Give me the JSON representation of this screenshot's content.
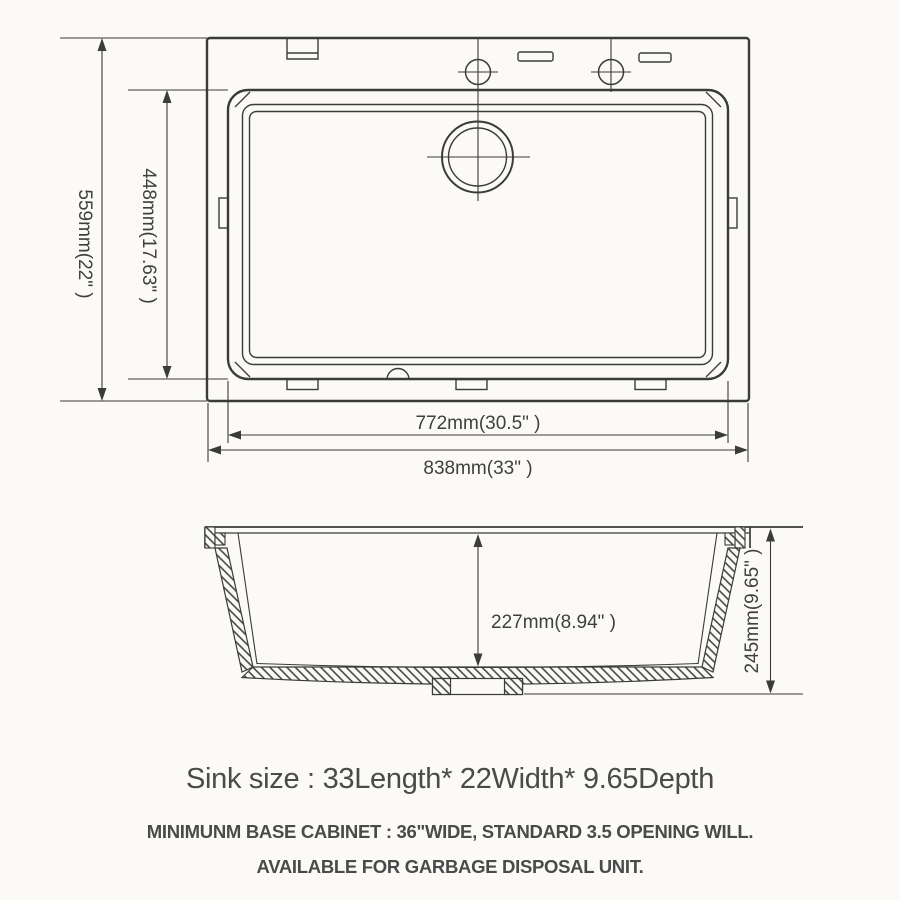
{
  "page": {
    "background": "#fbfaf7",
    "line_color": "#3b3b3b",
    "text_color": "#4a4a4a"
  },
  "top_view": {
    "dims": {
      "outer_height": "559mm(22\" )",
      "inner_height": "448mm(17.63\" )",
      "inner_width": "772mm(30.5\" )",
      "outer_width": "838mm(33\" )"
    }
  },
  "side_view": {
    "dims": {
      "inner_depth": "227mm(8.94\" )",
      "outer_depth": "245mm(9.65\" )"
    }
  },
  "caption": {
    "size_line": "Sink size :  33Length* 22Width* 9.65Depth",
    "cabinet_line": "MINIMUNM BASE CABINET : 36\"WIDE,   STANDARD 3.5 OPENING WILL.",
    "disposal_line": "AVAILABLE FOR GARBAGE DISPOSAL UNIT."
  }
}
